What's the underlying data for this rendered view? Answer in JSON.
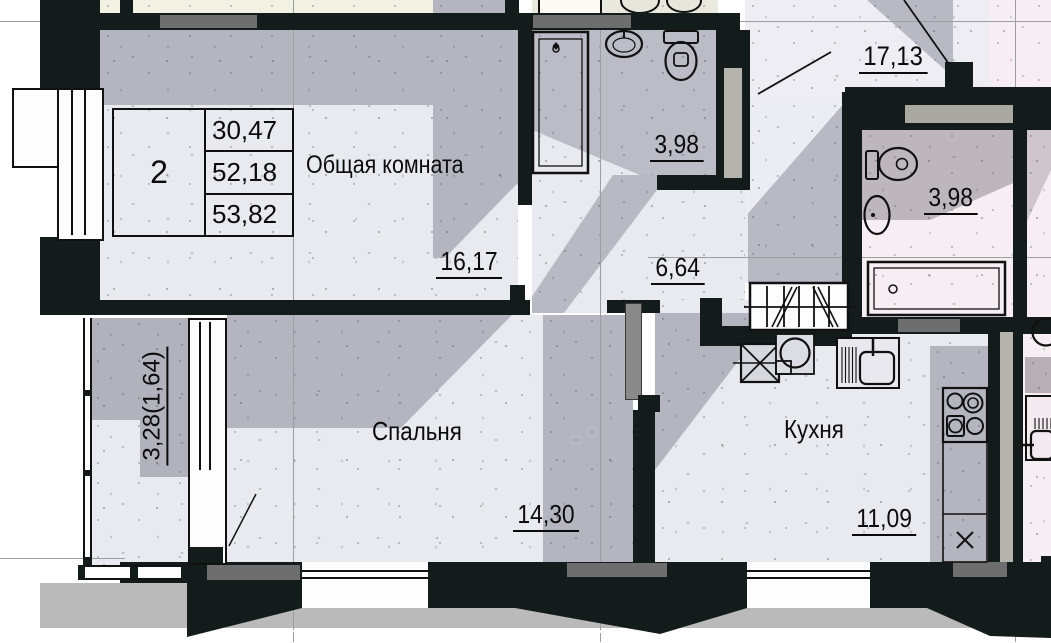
{
  "card": {
    "rooms_count": "2",
    "row1": "30,47",
    "row2": "52,18",
    "row3": "53,82"
  },
  "labels": {
    "living_name": "Общая комната",
    "living_area": "16,17",
    "corridor_area": "6,64",
    "bathroom_area": "3,98",
    "neighbor_room_area": "17,13",
    "neighbor_bathroom_area": "3,98",
    "bedroom_name": "Спальня",
    "bedroom_area": "14,30",
    "kitchen_name": "Кухня",
    "kitchen_area": "11,09",
    "balcony_area": "3,28(1,64)"
  },
  "palette": {
    "wall": "#141b1b",
    "floor_light": "#e9e9f0",
    "floor_gray": "#b5b5c0",
    "floor_cream": "#f1f1e4",
    "floor_pink": "#f6eef3",
    "pink_shadow": "#cfc6cd",
    "lintel": "#6e6e6e",
    "shaft_fill": "#b4b4ac",
    "door_leaf": "#898989",
    "ground": "#bababa",
    "axis_line": "#9b9fa1"
  }
}
